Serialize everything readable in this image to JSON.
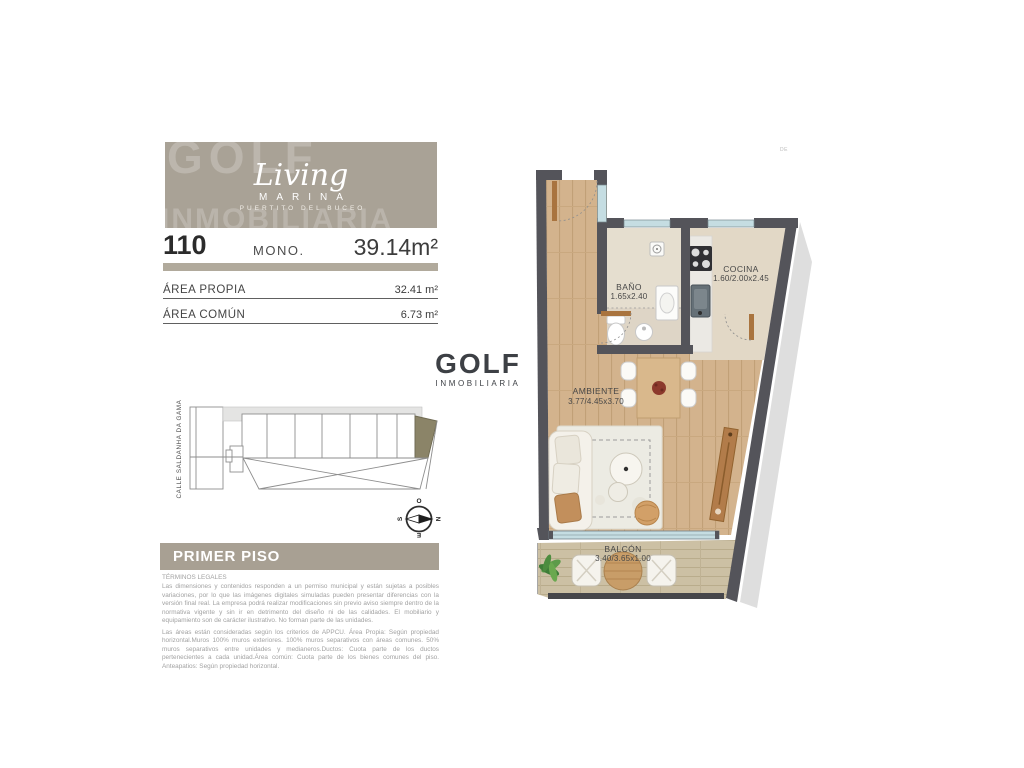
{
  "page_mark": "DE",
  "logo": {
    "watermark_line1": "GOLF",
    "watermark_line2": "INMOBILIARIA",
    "script": "Living",
    "sub": "MARINA",
    "tagline": "PUERTITO DEL BUCEO"
  },
  "unit": {
    "number": "110",
    "type": "MONO.",
    "total_area": "39.14m²",
    "rows": [
      {
        "label": "ÁREA PROPIA",
        "value": "32.41 m²"
      },
      {
        "label": "ÁREA COMÚN",
        "value": "6.73 m²"
      }
    ]
  },
  "brand": {
    "name": "GOLF",
    "sub": "INMOBILIARIA"
  },
  "keyplan": {
    "street": "CALLE SALDANHA DA GAMA"
  },
  "compass": {
    "west": "O",
    "north": "N",
    "south": "S",
    "east": "E"
  },
  "floor": {
    "banner": "PRIMER PISO"
  },
  "legal": {
    "title": "TÉRMINOS LEGALES",
    "p1": "Las dimensiones y contenidos responden a un permiso municipal y están sujetas a posibles variaciones, por lo que las imágenes digitales simuladas pueden presentar diferencias con la versión final real. La empresa podrá realizar modificaciones sin previo aviso siempre dentro de la normativa vigente y sin ir en detrimento del diseño ni de las calidades. El mobiliario y equipamiento son de carácter ilustrativo. No forman parte de las unidades.",
    "p2": "Las áreas están consideradas según los criterios de APPCU. Área Propia: Según propiedad horizontal.Muros 100% muros exteriores. 100% muros separativos con áreas comunes. 50% muros separativos entre unidades y medianeros.Ductos: Cuota parte de los ductos pertenecientes a cada unidad.Área común: Cuota parte de los bienes comunes del piso. Anteapatios: Según propiedad horizontal."
  },
  "plan": {
    "bano": {
      "name": "BAÑO",
      "dims": "1.65x2.40"
    },
    "cocina": {
      "name": "COCINA",
      "dims": "1.60/2.00x2.45"
    },
    "ambiente": {
      "name": "AMBIENTE",
      "dims": "3.77/4.45x3.70"
    },
    "balcon": {
      "name": "BALCÓN",
      "dims": "3.40/3.65x1.00"
    }
  },
  "colors": {
    "wall": "#54545a",
    "beige_brand": "#a9a296",
    "highlight_unit": "#8b8468",
    "wood_floor": "#d3b38d",
    "window_glass": "#c5dde2"
  }
}
